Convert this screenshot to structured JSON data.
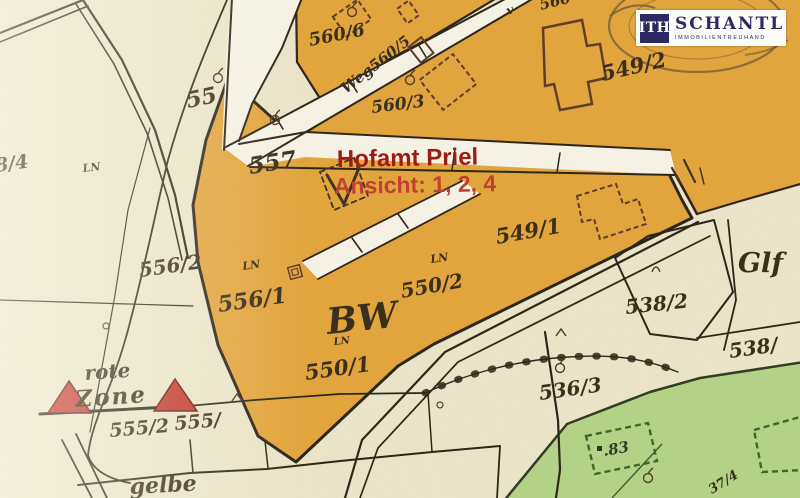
{
  "branding": {
    "logo_monogram": "ITH",
    "logo_name": "SCHANTL",
    "logo_subtitle": "IMMOBILIENTREUHAND",
    "brand_navy": "#2e2963"
  },
  "overlay": {
    "title": "Hofamt Priel",
    "subtitle": "Ansicht: 1, 2, 4",
    "title_color": "#9b120d",
    "subtitle_color": "#c0392e"
  },
  "map": {
    "colors": {
      "background": "#efead3",
      "highlight_orange": "#e6a63c",
      "road_white": "#fbf9f1",
      "green_area": "#b4d78b",
      "boundary_dark": "#221c14",
      "building_brown": "#5a3526",
      "red_zone": "#c43027",
      "label_dark": "#302518"
    },
    "labels": [
      {
        "text": "55",
        "x": 188,
        "y": 108,
        "rot": -12,
        "size": 22
      },
      {
        "text": "8/4",
        "x": -4,
        "y": 172,
        "rot": -8,
        "size": 19
      },
      {
        "text": "LN",
        "x": 83,
        "y": 172,
        "rot": -6,
        "size": 11
      },
      {
        "text": "557",
        "x": 250,
        "y": 174,
        "rot": -9,
        "size": 23
      },
      {
        "text": "560/6",
        "x": 310,
        "y": 46,
        "rot": -11,
        "size": 18
      },
      {
        "text": "Weg560/5",
        "x": 346,
        "y": 94,
        "rot": -38,
        "size": 15
      },
      {
        "text": "560/3",
        "x": 372,
        "y": 113,
        "rot": -7,
        "size": 17
      },
      {
        "text": "560",
        "x": 541,
        "y": 10,
        "rot": -14,
        "size": 15
      },
      {
        "text": "v",
        "x": 508,
        "y": 15,
        "rot": -20,
        "size": 12
      },
      {
        "text": "549/2",
        "x": 603,
        "y": 81,
        "rot": -13,
        "size": 21
      },
      {
        "text": "549/1",
        "x": 497,
        "y": 244,
        "rot": -10,
        "size": 21
      },
      {
        "text": "556/2",
        "x": 140,
        "y": 277,
        "rot": -8,
        "size": 20
      },
      {
        "text": "LN",
        "x": 243,
        "y": 270,
        "rot": -8,
        "size": 11
      },
      {
        "text": "556/1",
        "x": 219,
        "y": 312,
        "rot": -8,
        "size": 22
      },
      {
        "text": "550/2",
        "x": 402,
        "y": 298,
        "rot": -10,
        "size": 20
      },
      {
        "text": "LN",
        "x": 431,
        "y": 263,
        "rot": -8,
        "size": 11
      },
      {
        "text": "BW",
        "x": 328,
        "y": 334,
        "rot": -6,
        "size": 36
      },
      {
        "text": "LN",
        "x": 334,
        "y": 345,
        "rot": -6,
        "size": 10
      },
      {
        "text": "550/1",
        "x": 306,
        "y": 380,
        "rot": -8,
        "size": 21
      },
      {
        "text": "536/3",
        "x": 540,
        "y": 400,
        "rot": -8,
        "size": 20
      },
      {
        "text": "538/2",
        "x": 626,
        "y": 314,
        "rot": -6,
        "size": 20
      },
      {
        "text": "Glf",
        "x": 738,
        "y": 272,
        "rot": 0,
        "size": 27
      },
      {
        "text": "538/",
        "x": 730,
        "y": 358,
        "rot": -8,
        "size": 20
      },
      {
        "text": "rote",
        "x": 85,
        "y": 380,
        "rot": -4,
        "size": 20
      },
      {
        "text": "Zone",
        "x": 76,
        "y": 407,
        "rot": -4,
        "size": 23,
        "ls": 2
      },
      {
        "text": "555/2",
        "x": 110,
        "y": 437,
        "rot": -5,
        "size": 19
      },
      {
        "text": "555/",
        "x": 175,
        "y": 430,
        "rot": -5,
        "size": 19
      },
      {
        "text": "gelbe",
        "x": 130,
        "y": 494,
        "rot": -3,
        "size": 22
      },
      {
        "text": ".83",
        "x": 604,
        "y": 456,
        "rot": -10,
        "size": 15,
        "color": "#27341e"
      },
      {
        "text": "37/4",
        "x": 712,
        "y": 494,
        "rot": -32,
        "size": 13
      },
      {
        "text": "Hofamt Priel",
        "x": 337,
        "y": 167,
        "rot": -1,
        "size": 24,
        "color": "#9b120d",
        "sans": true,
        "bold": true,
        "name": "overlay-title"
      },
      {
        "text": "Ansicht: 1, 2, 4",
        "x": 334,
        "y": 194,
        "rot": -1,
        "size": 23,
        "color": "#c0392e",
        "sans": true,
        "bold": true,
        "name": "overlay-subtitle"
      }
    ],
    "symbols": [
      {
        "type": "fruit-tree",
        "x": 218,
        "y": 78
      },
      {
        "type": "fruit-tree",
        "x": 275,
        "y": 120
      },
      {
        "type": "fruit-tree",
        "x": 410,
        "y": 80
      },
      {
        "type": "fruit-tree",
        "x": 352,
        "y": 12
      },
      {
        "type": "fruit-tree",
        "x": 560,
        "y": 368
      },
      {
        "type": "fruit-tree",
        "x": 648,
        "y": 478
      },
      {
        "type": "dot-circle",
        "x": 106,
        "y": 326
      },
      {
        "type": "dot-circle",
        "x": 440,
        "y": 405
      },
      {
        "type": "caret",
        "x": 237,
        "y": 398
      },
      {
        "type": "caret",
        "x": 561,
        "y": 333
      },
      {
        "type": "arc-n",
        "x": 656,
        "y": 268
      }
    ]
  }
}
